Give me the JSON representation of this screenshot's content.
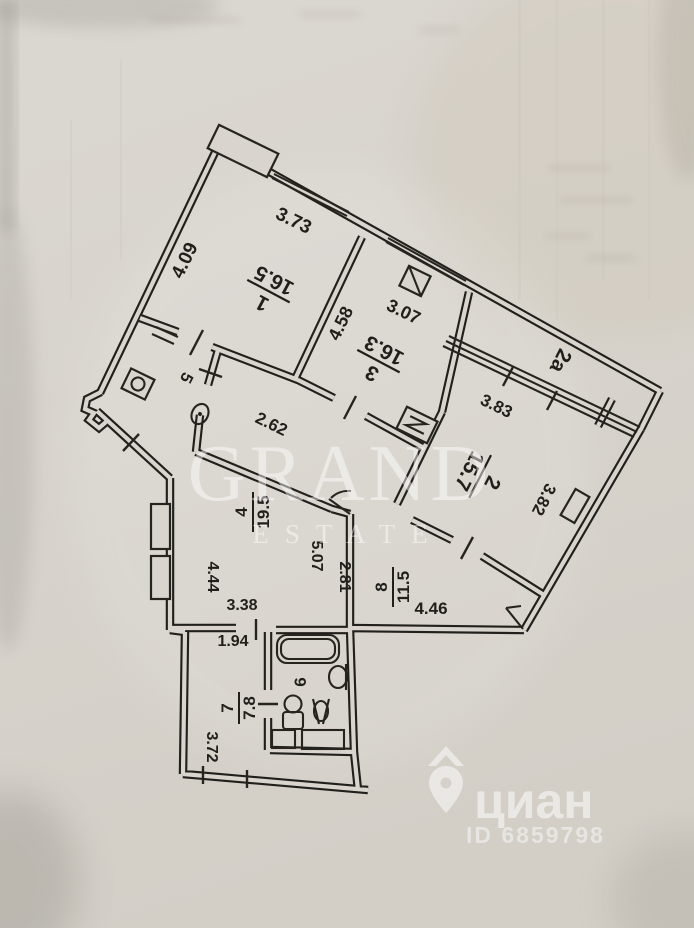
{
  "plan": {
    "rooms": [
      {
        "number": "1",
        "area": "16.5"
      },
      {
        "number": "3",
        "area": "16.3"
      },
      {
        "number": "2",
        "area": "15.7"
      },
      {
        "number": "4",
        "area": "19.5"
      },
      {
        "number": "8",
        "area": "11.5"
      },
      {
        "number": "7",
        "area": "7.8"
      },
      {
        "number": "5",
        "area": ""
      },
      {
        "number": "6",
        "area": ""
      },
      {
        "number": "2а",
        "area": ""
      }
    ],
    "dimensions": [
      "3.73",
      "4.09",
      "3.07",
      "4.58",
      "3.83",
      "3.82",
      "2.62",
      "5.07",
      "2.81",
      "4.46",
      "3.38",
      "4.44",
      "1.94",
      "3.72"
    ]
  },
  "watermarks": {
    "agency": {
      "name": "GRAND",
      "sub": "ESTATE"
    },
    "portal": {
      "name": "циан",
      "listing_id": "ID 6859798"
    }
  }
}
